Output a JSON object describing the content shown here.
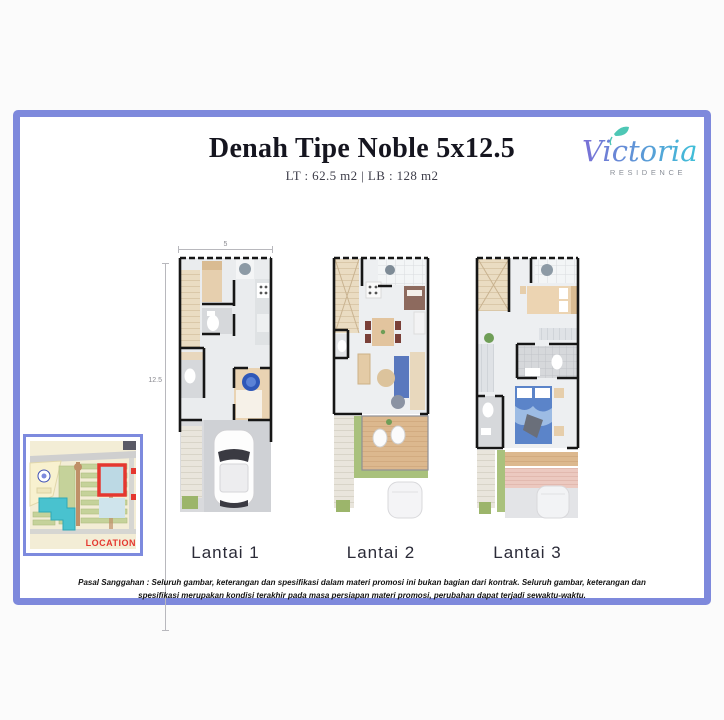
{
  "header": {
    "title": "Denah Tipe Noble 5x12.5",
    "subtitle": "LT : 62.5 m2 |  LB : 128 m2"
  },
  "logo": {
    "brand": "Victoria",
    "subtitle": "RESIDENCE"
  },
  "floor_plans": {
    "dimension_width": "5",
    "dimension_depth": "12.5",
    "plans": [
      {
        "label": "Lantai 1"
      },
      {
        "label": "Lantai 2"
      },
      {
        "label": "Lantai 3"
      }
    ]
  },
  "location_map": {
    "label": "LOCATION"
  },
  "disclaimer": "Pasal Sanggahan : Seluruh gambar, keterangan dan spesifikasi dalam materi promosi ini bukan bagian dari kontrak. Seluruh gambar, keterangan dan spesifikasi merupakan kondisi terakhir pada masa persiapan materi promosi, perubahan dapat terjadi sewaktu-waktu.",
  "colors": {
    "frame_border": "#7e89dc",
    "logo_gradient_start": "#7a6fd6",
    "logo_gradient_end": "#3fc0d8",
    "location_accent": "#e5372f"
  }
}
